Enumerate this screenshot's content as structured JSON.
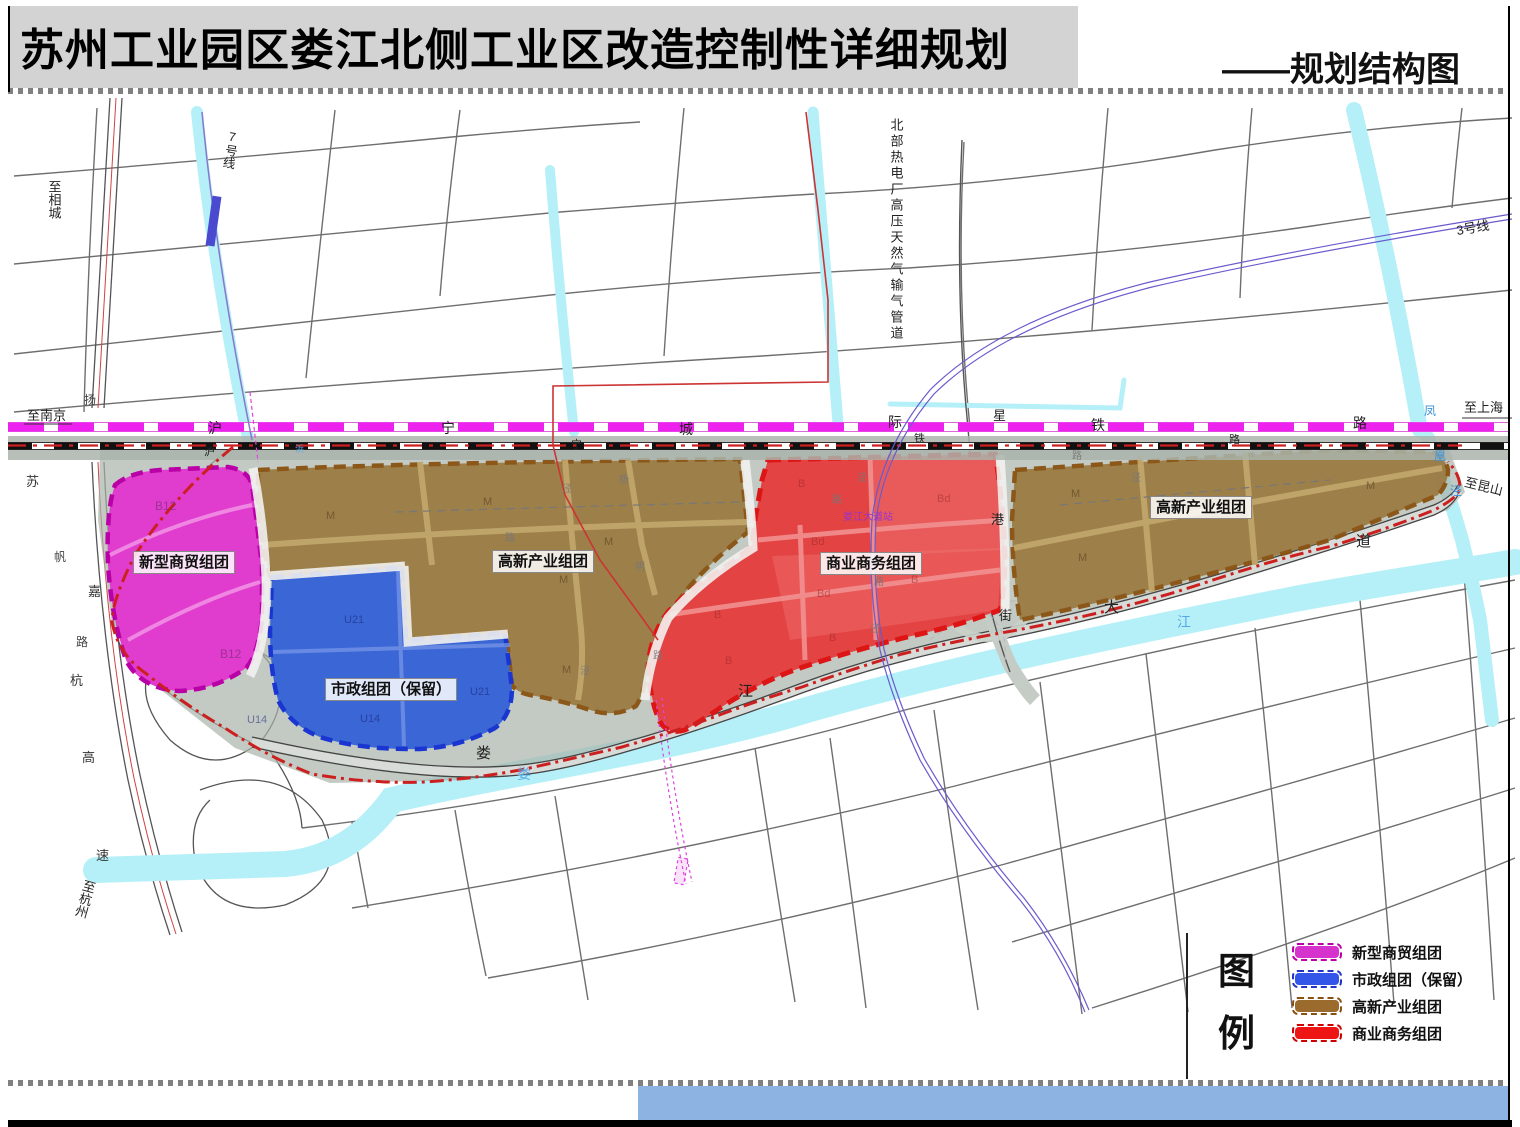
{
  "header": {
    "title": "苏州工业园区娄江北侧工业区改造控制性详细规划",
    "subtitle": "——规划结构图"
  },
  "map": {
    "rail": {
      "intercity": [
        "沪",
        "宁",
        "城",
        "际",
        "铁",
        "路"
      ],
      "mainline": [
        "沪",
        "宁",
        "铁",
        "路"
      ]
    },
    "metro": {
      "line7": "7号线",
      "line3": "3号线",
      "station": "娄江大道站"
    },
    "destinations": {
      "nanjing": "至南京",
      "xiangcheng": "至相城",
      "hangzhou": "至杭州",
      "shanghai": "至上海",
      "kunshan": "至昆山"
    },
    "zone_labels": {
      "commerce": "新型商贸组团",
      "municipal": "市政组团（保留）",
      "hightech": "高新产业组团",
      "business": "商业商务组团"
    },
    "codes": {
      "b12": "B12",
      "u21": "U21",
      "u14": "U14",
      "m": "M",
      "b": "B",
      "bd": "Bd"
    },
    "roads": {
      "loujiang_avenue": [
        "娄",
        "江",
        "大",
        "道"
      ],
      "xinggang_street": [
        "星",
        "港",
        "街"
      ],
      "expressway": [
        "苏",
        "嘉",
        "杭",
        "高",
        "速"
      ],
      "minor_fan": "帆",
      "minor_lu": "路",
      "minor_yang": "扬"
    },
    "rivers": {
      "loujiang": [
        "娄",
        "江"
      ],
      "fenghuangjing": [
        "凤",
        "凰",
        "泾"
      ]
    },
    "pipeline_label": "北部热电厂高压天然气输气管道",
    "minor": {
      "jing": "泾",
      "lu": "路",
      "ming": "明",
      "yang": "扬",
      "bang": "浜"
    }
  },
  "legend": {
    "heading": [
      "图",
      "例"
    ],
    "items": [
      {
        "label": "新型商贸组团",
        "color": "#d633cc",
        "border": "#bb00aa"
      },
      {
        "label": "市政组团（保留）",
        "color": "#3355e8",
        "border": "#2233cc"
      },
      {
        "label": "高新产业组团",
        "color": "#9b6b2e",
        "border": "#8a5212"
      },
      {
        "label": "商业商务组团",
        "color": "#ee1515",
        "border": "#cc0000"
      }
    ]
  },
  "colors": {
    "zone_commerce": "#e03cce",
    "zone_municipal": "#3a66d6",
    "zone_hightech": "#9b7b44",
    "zone_business": "#e34343",
    "railway_intercity": "#ee22ee",
    "boundary": "#cc2020",
    "river": "#b5f0f8",
    "header_bg": "#d3d3d3",
    "footer_bar": "#8db3e2"
  }
}
